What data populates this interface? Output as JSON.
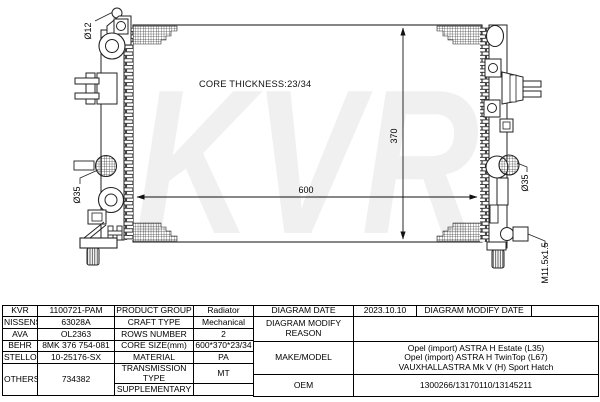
{
  "diagram": {
    "labels": {
      "watermark": "KVR",
      "core_thickness": "CORE THICKNESS:23/34",
      "width_mm": "600",
      "height_mm": "370",
      "inlet_diameter": "Ø12",
      "left_port_diameter": "Ø35",
      "right_port_diameter": "Ø35",
      "drain_plug_thread": "M11.5x1.5"
    },
    "colors": {
      "line": "#222222",
      "watermark_gray": "#f0f0f0"
    }
  },
  "table": {
    "brand_rows": [
      {
        "brand": "KVR",
        "code": "1100721-PAM"
      },
      {
        "brand": "NISSENS",
        "code": "63028A"
      },
      {
        "brand": "AVA",
        "code": "OL2363"
      },
      {
        "brand": "BEHR",
        "code": "8MK 376 754-081"
      },
      {
        "brand": "STELLOX",
        "code": "10-25176-SX"
      },
      {
        "brand": "OTHERS",
        "code": "734382"
      }
    ],
    "spec_rows": [
      {
        "label": "PRODUCT GROUP",
        "value": "Radiator"
      },
      {
        "label": "CRAFT TYPE",
        "value": "Mechanical"
      },
      {
        "label": "ROWS NUMBER",
        "value": "2"
      },
      {
        "label": "CORE SIZE(mm)",
        "value": "600*370*23/34"
      },
      {
        "label": "MATERIAL",
        "value": "PA"
      },
      {
        "label": "TRANSMISSION TYPE",
        "value": "MT"
      },
      {
        "label": "SUPPLEMENTARY",
        "value": ""
      }
    ],
    "right": {
      "diagram_date_label": "DIAGRAM DATE",
      "diagram_date": "2023.10.10",
      "modify_date_label": "DIAGRAM MODIFY DATE",
      "modify_date": "",
      "modify_reason_label": "DIAGRAM MODIFY REASON",
      "modify_reason": "",
      "make_model_label": "MAKE/MODEL",
      "make_model_lines": [
        "Opel (import) ASTRA H Estate (L35)",
        "Opel (import) ASTRA H TwinTop (L67)",
        "VAUXHALLASTRA Mk V (H) Sport Hatch"
      ],
      "oem_label": "OEM",
      "oem_value": "1300266/13170110/13145211"
    }
  }
}
